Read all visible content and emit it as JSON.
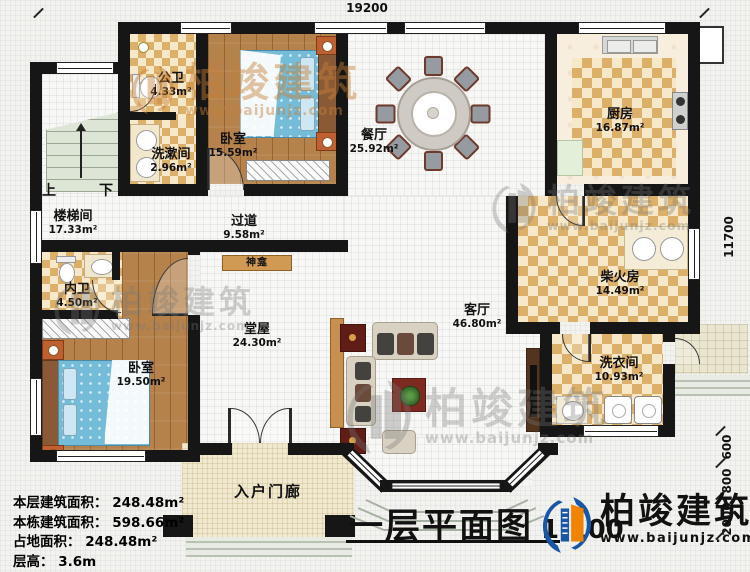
{
  "dimensions": {
    "top": "19200",
    "right_main": "11700",
    "right_a": "600",
    "right_b": "800",
    "right_c": "2000"
  },
  "rooms": {
    "loutijian": {
      "name": "楼梯间",
      "area": "17.33m²"
    },
    "gongwei": {
      "name": "公卫",
      "area": "4.33m²"
    },
    "xishujian": {
      "name": "洗漱间",
      "area": "2.96m²"
    },
    "woshi1": {
      "name": "卧室",
      "area": "15.59m²"
    },
    "canting": {
      "name": "餐厅",
      "area": "25.92m²"
    },
    "chufang": {
      "name": "厨房",
      "area": "16.87m²"
    },
    "chaihuofang": {
      "name": "柴火房",
      "area": "14.49m²"
    },
    "xiyijian": {
      "name": "洗衣间",
      "area": "10.93m²"
    },
    "guodao": {
      "name": "过道",
      "area": "9.58m²"
    },
    "neiwei": {
      "name": "内卫",
      "area": "4.50m²"
    },
    "woshi2": {
      "name": "卧室",
      "area": "19.50m²"
    },
    "tangwu": {
      "name": "堂屋",
      "area": "24.30m²"
    },
    "keting": {
      "name": "客厅",
      "area": "46.80m²"
    },
    "rumenlang": {
      "name": "入户门廊"
    },
    "shenkan": {
      "name": "神龛"
    }
  },
  "stairs": {
    "up": "上",
    "down": "下"
  },
  "info": {
    "line1": "本层建筑面积： 248.48m²",
    "line2": "本栋建筑面积： 598.66m²",
    "line3": "占地面积： 248.48m²",
    "line4": "层高： 3.6m"
  },
  "title": {
    "name": "一层平面图",
    "scale": "1:100"
  },
  "brand": {
    "name": "柏竣建筑",
    "url": "www.baijunjz.com"
  },
  "watermark": {
    "name": "柏竣建筑",
    "url": "www.baijunjz.com"
  },
  "colors": {
    "wall": "#161616",
    "logo_blue": "#1857a8",
    "logo_orange": "#f08300"
  }
}
